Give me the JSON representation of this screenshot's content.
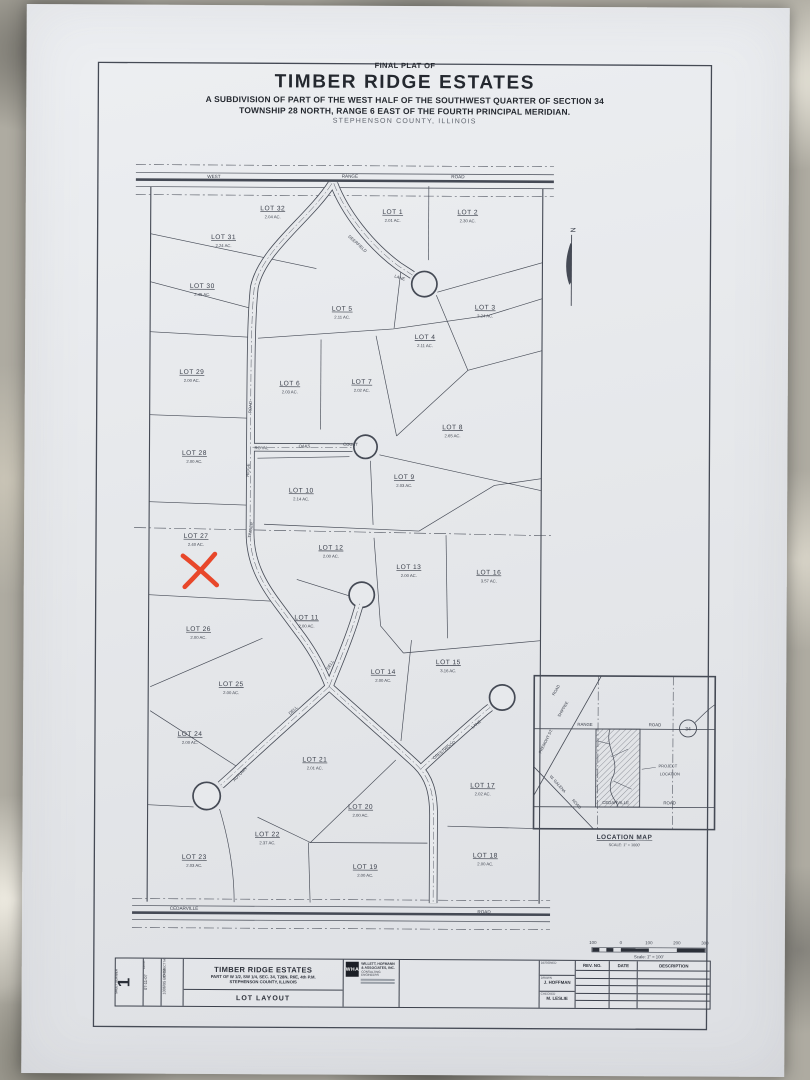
{
  "title": {
    "final_plat_of": "FINAL PLAT OF",
    "name": "TIMBER RIDGE ESTATES",
    "sub1": "A SUBDIVISION OF PART OF THE WEST HALF OF THE SOUTHWEST QUARTER OF SECTION 34",
    "sub2": "TOWNSHIP 28 NORTH, RANGE 6 EAST OF THE FOURTH PRINCIPAL MERIDIAN.",
    "county": "STEPHENSON COUNTY, ILLINOIS"
  },
  "plat": {
    "north_label": "N",
    "red_x_color": "#e8472a",
    "lots": [
      {
        "name": "LOT 32",
        "acres": "2.04 AC.",
        "x": 272,
        "y": 213
      },
      {
        "name": "LOT 1",
        "acres": "2.01 AC.",
        "x": 392,
        "y": 216
      },
      {
        "name": "LOT 2",
        "acres": "2.30 AC.",
        "x": 467,
        "y": 216
      },
      {
        "name": "LOT 31",
        "acres": "2.24 AC.",
        "x": 223,
        "y": 242
      },
      {
        "name": "LOT 30",
        "acres": "2.45 AC.",
        "x": 202,
        "y": 291
      },
      {
        "name": "LOT 5",
        "acres": "2.11 AC.",
        "x": 342,
        "y": 313
      },
      {
        "name": "LOT 3",
        "acres": "2.24 AC.",
        "x": 485,
        "y": 311
      },
      {
        "name": "LOT 4",
        "acres": "2.11 AC.",
        "x": 425,
        "y": 341
      },
      {
        "name": "LOT 29",
        "acres": "2.00 AC.",
        "x": 192,
        "y": 377
      },
      {
        "name": "LOT 6",
        "acres": "2.03 AC.",
        "x": 290,
        "y": 388
      },
      {
        "name": "LOT 7",
        "acres": "2.02 AC.",
        "x": 362,
        "y": 386
      },
      {
        "name": "LOT 8",
        "acres": "2.65 AC.",
        "x": 453,
        "y": 431
      },
      {
        "name": "LOT 28",
        "acres": "2.00 AC.",
        "x": 195,
        "y": 458
      },
      {
        "name": "LOT 10",
        "acres": "2.14 AC.",
        "x": 302,
        "y": 495
      },
      {
        "name": "LOT 9",
        "acres": "2.03 AC.",
        "x": 405,
        "y": 481
      },
      {
        "name": "LOT 27",
        "acres": "2.40 AC.",
        "x": 197,
        "y": 541
      },
      {
        "name": "LOT 12",
        "acres": "2.00 AC.",
        "x": 332,
        "y": 552
      },
      {
        "name": "LOT 13",
        "acres": "2.00 AC.",
        "x": 410,
        "y": 571
      },
      {
        "name": "LOT 16",
        "acres": "3.57 AC.",
        "x": 490,
        "y": 576
      },
      {
        "name": "LOT 11",
        "acres": "2.00 AC.",
        "x": 308,
        "y": 622
      },
      {
        "name": "LOT 26",
        "acres": "2.00 AC.",
        "x": 200,
        "y": 634
      },
      {
        "name": "LOT 25",
        "acres": "2.00 AC.",
        "x": 233,
        "y": 689
      },
      {
        "name": "LOT 14",
        "acres": "2.00 AC.",
        "x": 385,
        "y": 676
      },
      {
        "name": "LOT 15",
        "acres": "3.16 AC.",
        "x": 450,
        "y": 666
      },
      {
        "name": "LOT 24",
        "acres": "2.00 AC.",
        "x": 192,
        "y": 739
      },
      {
        "name": "LOT 21",
        "acres": "2.01 AC.",
        "x": 317,
        "y": 764
      },
      {
        "name": "LOT 17",
        "acres": "2.02 AC.",
        "x": 485,
        "y": 789
      },
      {
        "name": "LOT 20",
        "acres": "2.00 AC.",
        "x": 363,
        "y": 811
      },
      {
        "name": "LOT 22",
        "acres": "2.37 AC.",
        "x": 270,
        "y": 839
      },
      {
        "name": "LOT 23",
        "acres": "2.03 AC.",
        "x": 197,
        "y": 862
      },
      {
        "name": "LOT 19",
        "acres": "2.00 AC.",
        "x": 368,
        "y": 871
      },
      {
        "name": "LOT 18",
        "acres": "2.00 AC.",
        "x": 488,
        "y": 859
      }
    ],
    "road_labels": [
      {
        "text": "WEST",
        "x": 213,
        "y": 181,
        "rot": 0,
        "size": 4.6
      },
      {
        "text": "RANGE",
        "x": 349,
        "y": 180,
        "rot": 0,
        "size": 4.6
      },
      {
        "text": "ROAD",
        "x": 457,
        "y": 180,
        "rot": 0,
        "size": 4.6
      },
      {
        "text": "CEDARVILLE",
        "x": 187,
        "y": 913,
        "rot": 0,
        "size": 4.6
      },
      {
        "text": "ROAD",
        "x": 487,
        "y": 915,
        "rot": 0,
        "size": 4.6
      },
      {
        "text": "DEERFIELD",
        "x": 356,
        "y": 247,
        "rot": 42,
        "size": 4.2
      },
      {
        "text": "LANE",
        "x": 399,
        "y": 281,
        "rot": 18,
        "size": 4.2
      },
      {
        "text": "ROAD",
        "x": 252,
        "y": 410,
        "rot": -87,
        "size": 4.2
      },
      {
        "text": "RIDGE",
        "x": 250,
        "y": 473,
        "rot": -87,
        "size": 4.2
      },
      {
        "text": "TIMBER",
        "x": 253,
        "y": 533,
        "rot": -80,
        "size": 4.2
      },
      {
        "text": "ROYAL",
        "x": 262,
        "y": 452,
        "rot": 0,
        "size": 4.2
      },
      {
        "text": "OAKS",
        "x": 305,
        "y": 450,
        "rot": 0,
        "size": 4.2
      },
      {
        "text": "COURT",
        "x": 351,
        "y": 448,
        "rot": 0,
        "size": 4.2
      },
      {
        "text": "DELL",
        "x": 333,
        "y": 668,
        "rot": -58,
        "size": 4.2
      },
      {
        "text": "DELL",
        "x": 296,
        "y": 714,
        "rot": -44,
        "size": 4.2
      },
      {
        "text": "AUTUMN",
        "x": 243,
        "y": 778,
        "rot": -46,
        "size": 4.2
      },
      {
        "text": "CRESTWOOD",
        "x": 447,
        "y": 753,
        "rot": -38,
        "size": 4.2
      },
      {
        "text": "LANE",
        "x": 479,
        "y": 727,
        "rot": -38,
        "size": 4.2
      }
    ]
  },
  "location_map": {
    "title": "LOCATION MAP",
    "scale": "SCALE: 1\" = 1000'",
    "labels": [
      {
        "text": "RANGE",
        "x": 587,
        "y": 727,
        "rot": 0,
        "size": 4.3
      },
      {
        "text": "ROAD",
        "x": 657,
        "y": 727,
        "rot": 0,
        "size": 4.3
      },
      {
        "text": "CEDARVILLE",
        "x": 618,
        "y": 805,
        "rot": 0,
        "size": 4.3
      },
      {
        "text": "ROAD",
        "x": 672,
        "y": 805,
        "rot": 0,
        "size": 4.3
      },
      {
        "text": "ROAD",
        "x": 559,
        "y": 692,
        "rot": -60,
        "size": 4
      },
      {
        "text": "SHIPPEE",
        "x": 566,
        "y": 711,
        "rot": -60,
        "size": 4
      },
      {
        "text": "FREMONT ST.",
        "x": 549,
        "y": 743,
        "rot": -64,
        "size": 4
      },
      {
        "text": "W. GALENA",
        "x": 559,
        "y": 786,
        "rot": 48,
        "size": 4
      },
      {
        "text": "ROAD",
        "x": 578,
        "y": 806,
        "rot": 48,
        "size": 4
      },
      {
        "text": "PROJECT",
        "x": 670,
        "y": 768,
        "rot": 0,
        "size": 4
      },
      {
        "text": "LOCATION",
        "x": 672,
        "y": 776,
        "rot": 0,
        "size": 4
      },
      {
        "text": "34",
        "x": 690,
        "y": 731,
        "rot": 0,
        "size": 5
      }
    ]
  },
  "scale_bar": {
    "labels": [
      "100",
      "0",
      "100",
      "200",
      "300"
    ],
    "xs": [
      596,
      624,
      652,
      680,
      708
    ],
    "caption": "Scale: 1\" = 100'"
  },
  "tblock": {
    "sheet": {
      "label": "SHEET NUMBER",
      "value": "1"
    },
    "date": {
      "label": "DATE",
      "value": "07-11-07"
    },
    "project": {
      "label": "PROJECT NO.",
      "value": "1006/95 BO 03"
    },
    "main": {
      "line1": "TIMBER RIDGE ESTATES",
      "line2": "PART OF W 1/2, SW 1/4, SEC. 34, T28N, R6E, 4th P.M.",
      "line3": "STEPHENSON COUNTY, ILLINOIS",
      "sub": "LOT LAYOUT"
    },
    "firm": {
      "initials": "WHA",
      "name": "WILLETT, HOFMANN & ASSOCIATES, INC.",
      "tagline": "CONSULTING ENGINEERS"
    },
    "credits": [
      {
        "label": "DESIGNED",
        "value": ""
      },
      {
        "label": "DRAWN",
        "value": "J. HOFFMAN"
      },
      {
        "label": "CHECKED",
        "value": "M. LESLIE"
      }
    ],
    "rev": {
      "headers": [
        "REV. NO.",
        "DATE",
        "DESCRIPTION"
      ]
    }
  }
}
